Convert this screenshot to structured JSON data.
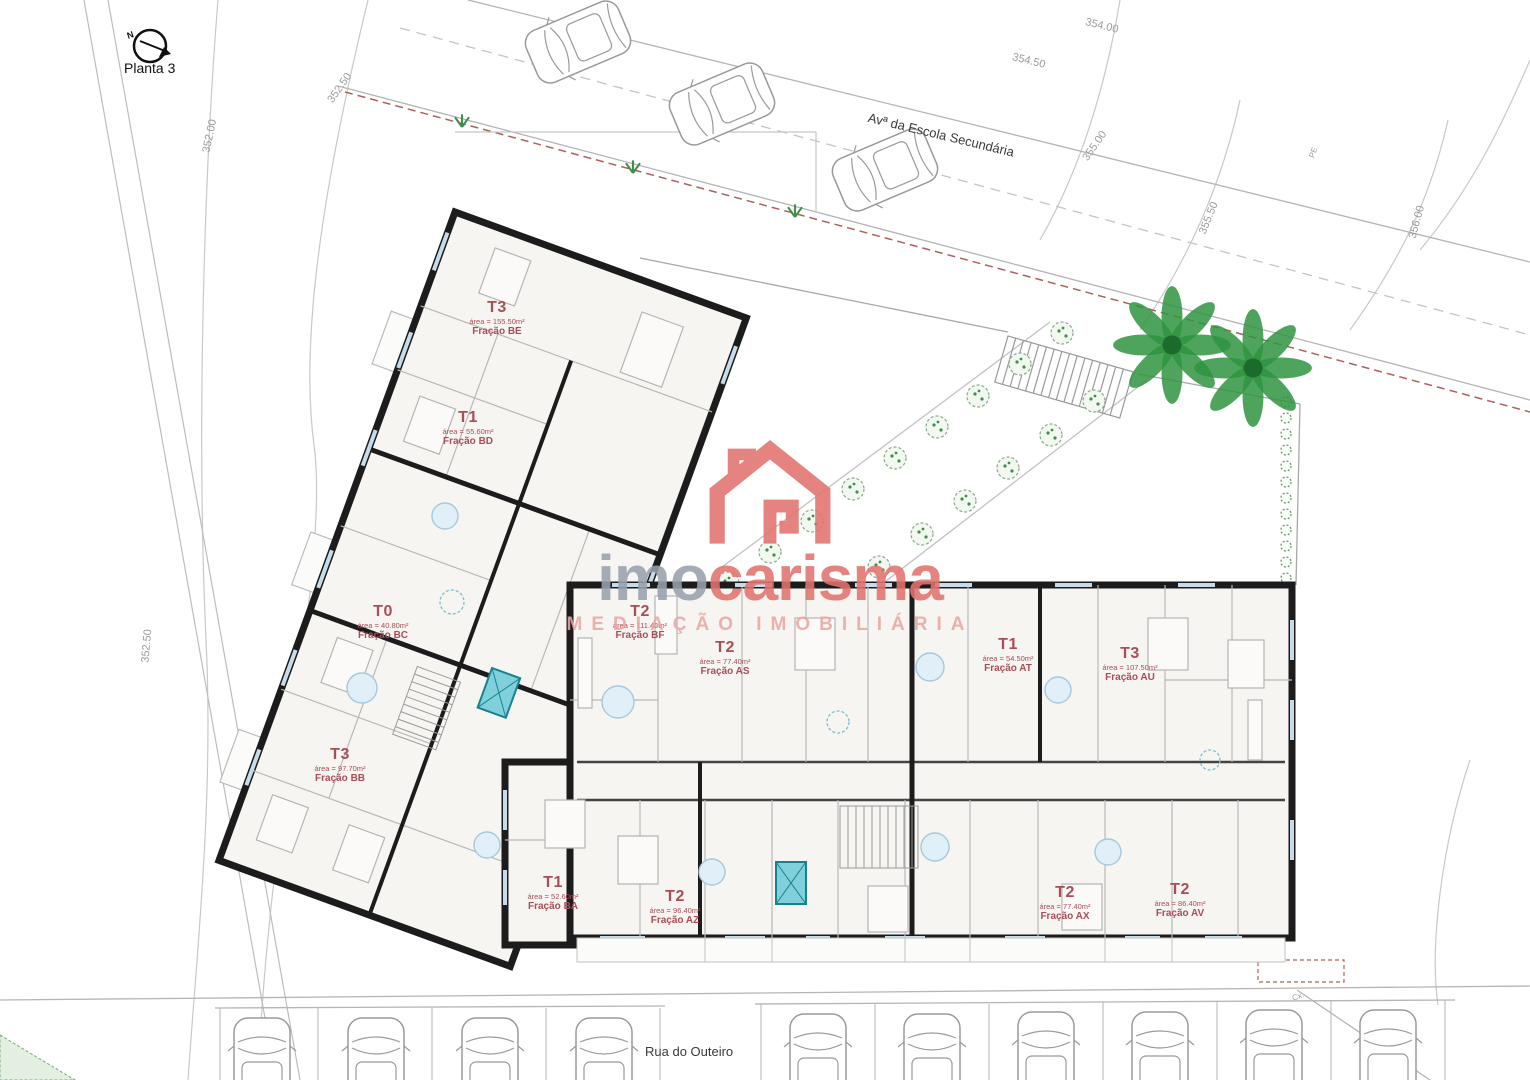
{
  "plan": {
    "title": "Planta 3"
  },
  "compass": {
    "north": "N"
  },
  "streets": {
    "top": "Avª da Escola Secundária",
    "bottom": "Rua do Outeiro"
  },
  "contours": [
    "352.00",
    "352.50",
    "352.50",
    "354.00",
    "354.50",
    "355.00",
    "355.50",
    "356.00"
  ],
  "annotations": {
    "pe": "PE",
    "cx": "Cx."
  },
  "logo": {
    "prefix": "imo",
    "name": "carisma",
    "tagline": "MEDIAÇÃO IMOBILIÁRIA"
  },
  "units": [
    {
      "type": "T3",
      "area": "área = 155.50m²",
      "fraction": "Fração BE"
    },
    {
      "type": "T1",
      "area": "área = 55.60m²",
      "fraction": "Fração BD"
    },
    {
      "type": "T0",
      "area": "área = 40.80m²",
      "fraction": "Fração BC"
    },
    {
      "type": "T3",
      "area": "área = 97.70m²",
      "fraction": "Fração BB"
    },
    {
      "type": "T1",
      "area": "área = 52.60m²",
      "fraction": "Fração BA"
    },
    {
      "type": "T2",
      "area": "área = 96.40m²",
      "fraction": "Fração AZ"
    },
    {
      "type": "T2",
      "area": "área = 111.40m²",
      "fraction": "Fração BF"
    },
    {
      "type": "T2",
      "area": "área = 77.40m²",
      "fraction": "Fração AS"
    },
    {
      "type": "T1",
      "area": "área = 54.50m²",
      "fraction": "Fração AT"
    },
    {
      "type": "T3",
      "area": "área = 107.50m²",
      "fraction": "Fração AU"
    },
    {
      "type": "T2",
      "area": "área = 77.40m²",
      "fraction": "Fração AX"
    },
    {
      "type": "T2",
      "area": "área = 86.40m²",
      "fraction": "Fração AV"
    }
  ],
  "colors": {
    "wall": "#1c1c1c",
    "unit_label": "#a84e56",
    "logo_red": "#e2736f",
    "logo_gray": "#99a1ad",
    "tree_green": "#2f9440",
    "boundary_red": "#b0605a",
    "window_blue": "#c6dcea",
    "elevator_teal": "#7fd0da"
  }
}
